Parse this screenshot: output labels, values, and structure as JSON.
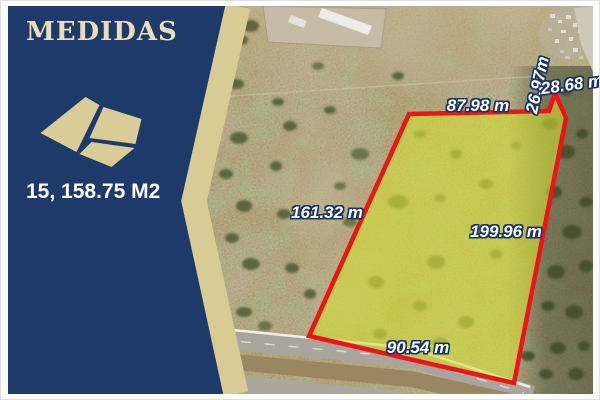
{
  "panel": {
    "title": "MEDIDAS",
    "area": "15, 158.75 M2",
    "icon": "parcel-diagram-icon",
    "colors": {
      "background": "#1e3a6b",
      "accent_stripe": "#d8cb94",
      "title_text": "#e8dfb8",
      "area_text": "#ffffff"
    }
  },
  "map": {
    "parcel": {
      "outline_color": "#ec1414",
      "highlight_color": "#d5e032",
      "measurements": [
        {
          "side": "top",
          "label": "87.98 m"
        },
        {
          "side": "upper-right-inner",
          "label": "26.97m"
        },
        {
          "side": "upper-right-outer",
          "label": "28.68 m"
        },
        {
          "side": "left",
          "label": "161.32 m"
        },
        {
          "side": "right",
          "label": "199.96 m"
        },
        {
          "side": "bottom",
          "label": "90.54 m"
        }
      ]
    }
  }
}
